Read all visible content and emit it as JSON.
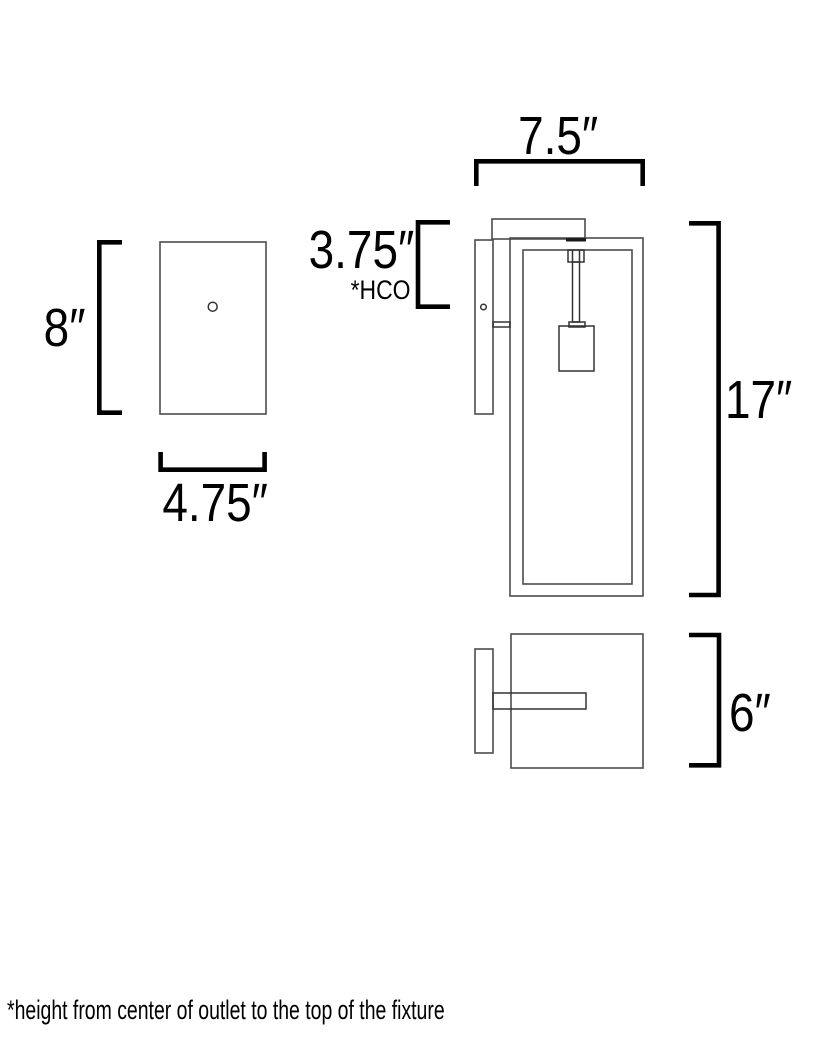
{
  "drawing": {
    "title": "wall-sconce-dimension-diagram",
    "front_view": {
      "height_label": "8″",
      "width_label": "4.75″"
    },
    "side_view": {
      "top_width_label": "7.5″",
      "hco_label": "3.75″",
      "hco_note": "*HCO",
      "height_label": "17″"
    },
    "top_view": {
      "depth_label": "6″"
    },
    "footnote": "*height from center of outlet to the top of the fixture"
  },
  "colors": {
    "line": "#4d4d4d",
    "line_dark": "#1a1a1a",
    "bracket": "#000000",
    "text": "#000000",
    "background": "#ffffff"
  }
}
